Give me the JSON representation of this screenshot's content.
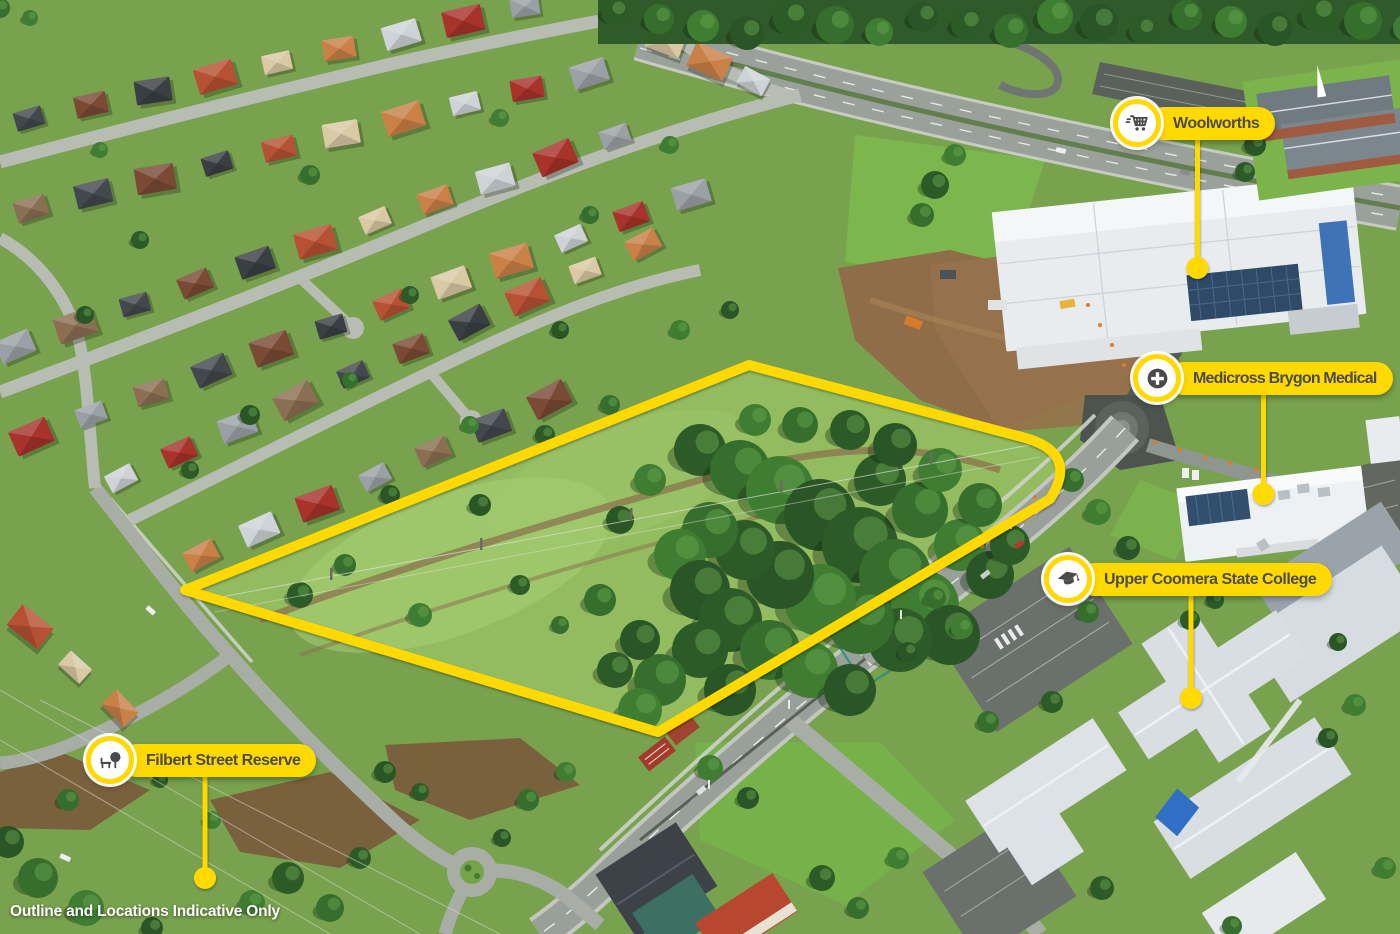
{
  "disclaimer": "Outline and Locations Indicative Only",
  "colors": {
    "accent_yellow": "#FFD900",
    "label_text": "#4C4C4E",
    "icon_gray": "#4A4A4C",
    "leader_dot": "#FFD900"
  },
  "labels": [
    {
      "id": "woolworths",
      "text": "Woolworths",
      "icon": "shopping-cart-icon"
    },
    {
      "id": "medicross-brygon-medical",
      "text": "Medicross Brygon Medical",
      "icon": "medical-cross-icon"
    },
    {
      "id": "upper-coomera-state-college",
      "text": "Upper Coomera State College",
      "icon": "graduation-cap-icon"
    },
    {
      "id": "filbert-street-reserve",
      "text": "Filbert Street Reserve",
      "icon": "park-bench-tree-icon"
    }
  ]
}
